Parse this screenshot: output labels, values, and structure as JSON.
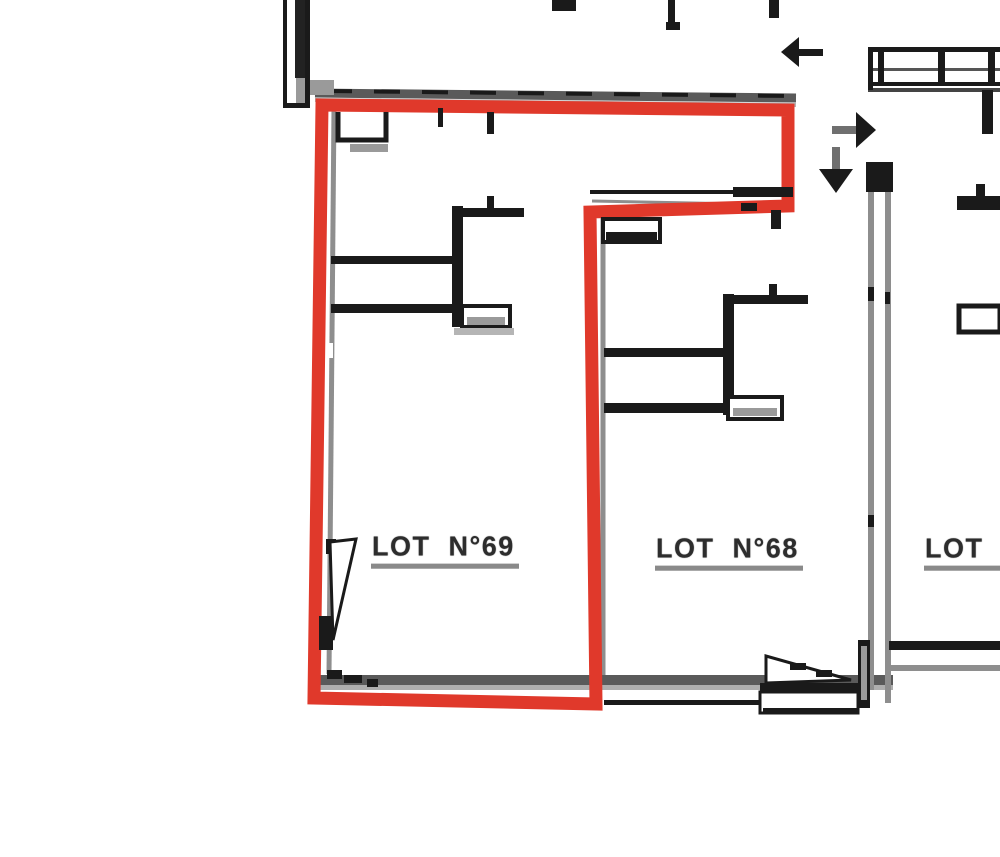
{
  "document": {
    "type": "architectural-floor-plan-crop",
    "description": "Black-and-white floor plan extract with one lot outlined in red"
  },
  "labels": {
    "lot69": "LOT  N°69",
    "lot68": "LOT  N°68",
    "lot_right_partial": "LOT"
  },
  "highlight": {
    "lot": "LOT N°69",
    "color": "#e0392b"
  },
  "colors": {
    "wall_black": "#1a1a1a",
    "wall_gray": "#8e8e8e",
    "band_dark_gray": "#5a5a5a",
    "band_light_gray": "#aeaeae",
    "label_text": "#2d2d2d",
    "label_underline": "#8a8a8a",
    "background": "#ffffff"
  },
  "icons": {
    "arrows": [
      "arrow-left-icon",
      "arrow-right-icon",
      "arrow-down-icon"
    ]
  }
}
